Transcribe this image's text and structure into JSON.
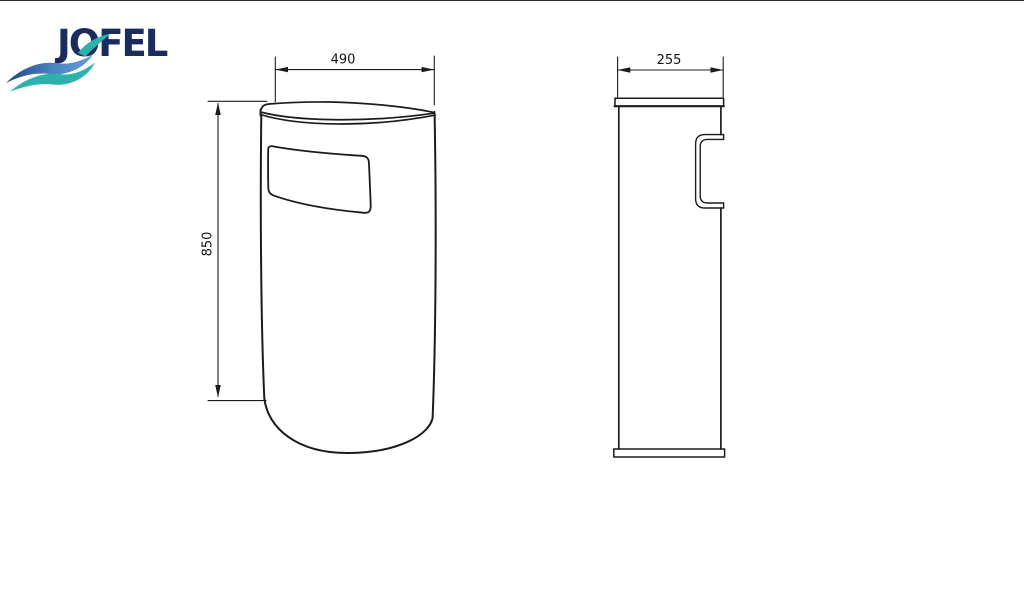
{
  "page": {
    "background": "#ffffff",
    "top_border_color": "#2b2b2b"
  },
  "logo": {
    "brand": "JOFEL",
    "navy": "#1c2b5e",
    "wave_blue_dark": "#27447f",
    "wave_blue": "#4a86c2",
    "wave_teal": "#2bb3ab"
  },
  "drawing": {
    "line_color": "#1c1c1c",
    "front_view": {
      "width_label": "490",
      "height_label": "850"
    },
    "side_view": {
      "depth_label": "255"
    }
  }
}
